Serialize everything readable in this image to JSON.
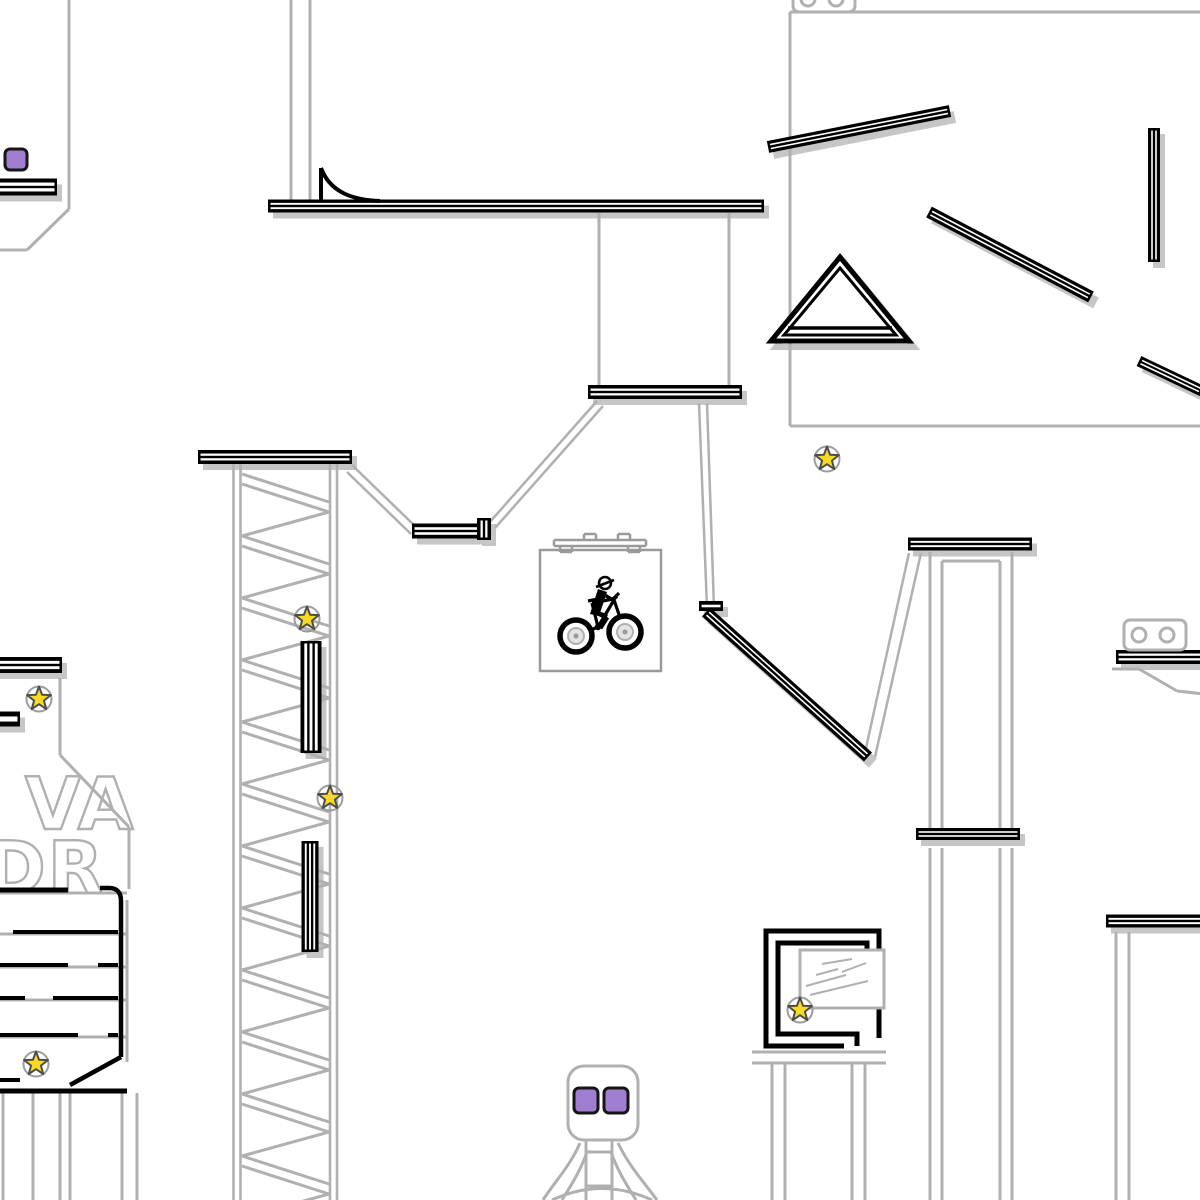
{
  "meta": {
    "view": "bike-trials-track-overview",
    "canvas_w": 1200,
    "canvas_h": 1200
  },
  "colors": {
    "background": "#ffffff",
    "track": "#000000",
    "stripe": "#ffffff",
    "shadow": "#c6c6c6",
    "scenery": "#b0b0b0",
    "box_stroke": "#9a9a9a",
    "star_fill": "#f7da21",
    "star_stroke": "#4c4c4c",
    "star_ring": "#9c9c9c",
    "checkpoint_fill": "#a07dd0",
    "checkpoint_stroke": "#151515",
    "wheel_inner": "#e3e3e3",
    "wheel_hub": "#9a9a9a"
  },
  "shadow_offset": {
    "dx": 5,
    "dy": 6
  },
  "beams": [
    [
      -8,
      187,
      57,
      187,
      17,
      2
    ],
    [
      268,
      206,
      764,
      206,
      13,
      2
    ],
    [
      588,
      392,
      742,
      392,
      14,
      2
    ],
    [
      198,
      457,
      352,
      457,
      14,
      2
    ],
    [
      412,
      531,
      491,
      531,
      15,
      2
    ],
    [
      484,
      518,
      484,
      540,
      14,
      2
    ],
    [
      699,
      606,
      723,
      606,
      10,
      1
    ],
    [
      706,
      612,
      868,
      757,
      12,
      2
    ],
    [
      908,
      544,
      1032,
      544,
      13,
      2
    ],
    [
      916,
      834,
      1020,
      834,
      12,
      2
    ],
    [
      768,
      147,
      950,
      111,
      12,
      2
    ],
    [
      929,
      212,
      1091,
      297,
      12,
      2
    ],
    [
      1154,
      128,
      1154,
      262,
      12,
      2
    ],
    [
      1139,
      361,
      1202,
      391,
      11,
      2
    ],
    [
      1116,
      657,
      1204,
      657,
      14,
      2
    ],
    [
      311,
      641,
      311,
      753,
      21,
      3
    ],
    [
      310,
      841,
      310,
      952,
      17,
      3
    ],
    [
      -6,
      665,
      62,
      665,
      16,
      2
    ],
    [
      -6,
      719,
      20,
      719,
      15,
      1
    ],
    [
      1106,
      921,
      1204,
      921,
      13,
      2
    ]
  ],
  "triangle": {
    "apex": [
      840,
      257
    ],
    "base_left": [
      771,
      341
    ],
    "base_right": [
      909,
      341
    ],
    "inner_apex": [
      840,
      268
    ],
    "inner_left": [
      784,
      335
    ],
    "inner_right": [
      896,
      335
    ],
    "baseline": [
      788,
      328,
      892,
      328
    ]
  },
  "scenery_lines": [
    [
      69,
      0,
      69,
      209,
      3
    ],
    [
      69,
      209,
      27,
      250,
      3
    ],
    [
      27,
      250,
      -2,
      250,
      3
    ],
    [
      291,
      0,
      291,
      200,
      3
    ],
    [
      310,
      0,
      310,
      200,
      3
    ],
    [
      599,
      213,
      599,
      386,
      3
    ],
    [
      729,
      213,
      729,
      386,
      3
    ],
    [
      352,
      465,
      417,
      528,
      2.5
    ],
    [
      347,
      472,
      411,
      534,
      2.5
    ],
    [
      489,
      523,
      597,
      401,
      2.5
    ],
    [
      495,
      528,
      603,
      406,
      2.5
    ],
    [
      699,
      403,
      707,
      608,
      2.5
    ],
    [
      707,
      403,
      714,
      608,
      2.5
    ],
    [
      864,
      757,
      909,
      553,
      2.5
    ],
    [
      875,
      757,
      921,
      553,
      2.5
    ],
    [
      60,
      678,
      60,
      755,
      3
    ],
    [
      60,
      755,
      129,
      827,
      3
    ],
    [
      129,
      827,
      129,
      889,
      3
    ],
    [
      790,
      12,
      1200,
      12,
      3
    ],
    [
      790,
      12,
      790,
      426,
      3
    ],
    [
      790,
      426,
      1200,
      426,
      3
    ],
    [
      1116,
      932,
      1116,
      1200,
      3
    ],
    [
      1129,
      932,
      1129,
      1200,
      3
    ],
    [
      1112,
      669,
      1139,
      669,
      3
    ],
    [
      1139,
      669,
      1177,
      691,
      3
    ],
    [
      1177,
      691,
      1204,
      694,
      3
    ],
    [
      930,
      552,
      930,
      829,
      3
    ],
    [
      1012,
      552,
      1012,
      829,
      3
    ],
    [
      942,
      561,
      942,
      829,
      3
    ],
    [
      1000,
      561,
      1000,
      829,
      3
    ],
    [
      942,
      561,
      1000,
      561,
      3
    ],
    [
      930,
      848,
      930,
      1200,
      3
    ],
    [
      942,
      848,
      942,
      1200,
      3
    ],
    [
      1000,
      848,
      1000,
      1200,
      3
    ],
    [
      1012,
      848,
      1012,
      1200,
      3
    ],
    [
      0,
      893,
      127,
      893,
      3
    ],
    [
      0,
      934,
      127,
      934,
      3
    ],
    [
      0,
      967,
      127,
      967,
      3
    ],
    [
      0,
      1000,
      127,
      1000,
      3
    ],
    [
      0,
      1037,
      127,
      1037,
      3
    ],
    [
      127,
      900,
      127,
      1062,
      3
    ],
    [
      3,
      1093,
      3,
      1200,
      3
    ],
    [
      33,
      1093,
      33,
      1200,
      3
    ],
    [
      60,
      1093,
      60,
      1200,
      3
    ],
    [
      70,
      1093,
      70,
      1200,
      3
    ],
    [
      122,
      1093,
      122,
      1200,
      3
    ],
    [
      137,
      1093,
      137,
      1200,
      3
    ],
    [
      752,
      1052,
      886,
      1052,
      3
    ],
    [
      752,
      1063,
      886,
      1063,
      3
    ],
    [
      772,
      1063,
      772,
      1200,
      3
    ],
    [
      785,
      1063,
      785,
      1200,
      3
    ],
    [
      852,
      1063,
      852,
      1200,
      3
    ],
    [
      865,
      1063,
      865,
      1200,
      3
    ],
    [
      586,
      1140,
      586,
      1200,
      3
    ],
    [
      612,
      1140,
      612,
      1200,
      3
    ],
    [
      586,
      1152,
      612,
      1152,
      3
    ],
    [
      586,
      1186,
      612,
      1186,
      3
    ]
  ],
  "scenery_paths": [
    "M580,1143 C570,1166 556,1180 543,1200",
    "M587,1152 C580,1172 570,1187 562,1200",
    "M618,1143 C629,1166 643,1181 657,1200",
    "M611,1152 C618,1172 628,1187 636,1200",
    "M552,1200 Q602,1177 652,1200"
  ],
  "roof_lines": [
    [
      554,
      540,
      646,
      540,
      2.5
    ],
    [
      554,
      546,
      646,
      546,
      2.5
    ],
    [
      554,
      540,
      554,
      546,
      2.5
    ],
    [
      646,
      540,
      646,
      546,
      2.5
    ],
    [
      560,
      546,
      560,
      552,
      2.5
    ],
    [
      572,
      546,
      572,
      552,
      2.5
    ],
    [
      560,
      552,
      572,
      552,
      2.5
    ],
    [
      628,
      546,
      628,
      552,
      2.5
    ],
    [
      640,
      546,
      640,
      552,
      2.5
    ],
    [
      628,
      552,
      640,
      552,
      2.5
    ],
    [
      584,
      534,
      596,
      534,
      2.5
    ],
    [
      584,
      534,
      584,
      540,
      2.5
    ],
    [
      596,
      534,
      596,
      540,
      2.5
    ],
    [
      618,
      534,
      630,
      534,
      2.5
    ],
    [
      618,
      534,
      618,
      540,
      2.5
    ],
    [
      630,
      534,
      630,
      540,
      2.5
    ]
  ],
  "player_box": {
    "x": 540,
    "y": 550,
    "w": 121,
    "h": 121
  },
  "tower": {
    "rails": [
      233.5,
      240.5,
      330,
      337
    ],
    "top": 464,
    "bottom": 1200,
    "zig_left": 242,
    "zig_right": 329,
    "zig_start": 474,
    "cycle": 62
  },
  "track_paths": [
    {
      "d": "M321,168 L321,201",
      "w": 4
    },
    {
      "d": "M321,168 C330,192 352,200 380,201",
      "w": 4
    },
    {
      "d": "M0,890 H68",
      "w": 5
    },
    {
      "d": "M100,888 H109 Q121,888 121,901 V1057",
      "w": 4.5
    },
    {
      "d": "M13,932 H118",
      "w": 4
    },
    {
      "d": "M0,965 H68",
      "w": 4
    },
    {
      "d": "M98,965 H118",
      "w": 4
    },
    {
      "d": "M0,998 H25",
      "w": 4
    },
    {
      "d": "M53,998 H118",
      "w": 4
    },
    {
      "d": "M0,1035 H78",
      "w": 4
    },
    {
      "d": "M108,1035 H118",
      "w": 4
    },
    {
      "d": "M0,1080 H20",
      "w": 4
    },
    {
      "d": "M70,1085 L121,1057",
      "w": 4.5
    },
    {
      "d": "M0,1091 H127",
      "w": 5
    },
    {
      "d": "M879,974 V931 H766 V1046 H844",
      "w": 5
    },
    {
      "d": "M867,974 V943 H778 V1034 H857 V1046",
      "w": 5
    },
    {
      "d": "M879,1006 V1038",
      "w": 5
    }
  ],
  "picture": {
    "x": 800,
    "y": 950,
    "w": 84,
    "h": 58,
    "scribbles": [
      [
        806,
        986,
        846,
        975
      ],
      [
        810,
        995,
        868,
        981
      ],
      [
        816,
        975,
        838,
        969
      ],
      [
        842,
        972,
        866,
        963
      ],
      [
        822,
        964,
        852,
        959
      ]
    ]
  },
  "letters": {
    "line1": {
      "text": "L VA",
      "x": -50,
      "y": 829,
      "size": 72
    },
    "line2": {
      "text": "DR",
      "x": -14,
      "y": 893,
      "size": 72
    }
  },
  "camera_boxes": [
    {
      "x": 1124,
      "y": 620,
      "w": 62,
      "h": 30,
      "rx": 6,
      "eyes": [
        [
          1139,
          635
        ],
        [
          1167,
          635
        ]
      ],
      "eye_r": 7
    },
    {
      "x": 793,
      "y": -16,
      "w": 62,
      "h": 28,
      "rx": 6,
      "eyes": [
        [
          808,
          -1
        ],
        [
          836,
          -1
        ]
      ],
      "eye_r": 7
    }
  ],
  "robot_head": {
    "x": 568,
    "y": 1066,
    "w": 70,
    "h": 74,
    "rx": 16
  },
  "stars": [
    [
      307,
      619
    ],
    [
      39,
      699
    ],
    [
      330,
      798
    ],
    [
      827,
      459
    ],
    [
      800,
      1010
    ],
    [
      36,
      1064
    ]
  ],
  "star_geom": {
    "outer_r": 12.5,
    "inner_r": 5.2,
    "ring_r": 12.5
  },
  "checkpoints": [
    [
      5,
      149,
      22,
      21
    ],
    [
      574,
      1088,
      24,
      25
    ],
    [
      604,
      1088,
      24,
      25
    ]
  ],
  "biker": {
    "wheels": [
      [
        576,
        636
      ],
      [
        625,
        632
      ]
    ],
    "wheel_r": 16,
    "frame_lines": [
      [
        576,
        636,
        598,
        627
      ],
      [
        598,
        627,
        592,
        603
      ],
      [
        588,
        601,
        598,
        599
      ],
      [
        598,
        627,
        614,
        600
      ],
      [
        592,
        603,
        613,
        599
      ],
      [
        613,
        597,
        625,
        632
      ],
      [
        613,
        599,
        619,
        593
      ]
    ],
    "crank": [
      598,
      627,
      3.2
    ],
    "body": "M590,614 L598,589 L607,592 L599,616 Z",
    "leg_lines": [
      [
        595,
        612,
        607,
        617
      ],
      [
        607,
        617,
        600,
        628
      ]
    ],
    "arm_lines": [
      [
        603,
        594,
        613,
        600
      ],
      [
        613,
        600,
        617,
        596
      ]
    ],
    "head": [
      605,
      583,
      6
    ],
    "visor": [
      596,
      587,
      614,
      580
    ]
  }
}
